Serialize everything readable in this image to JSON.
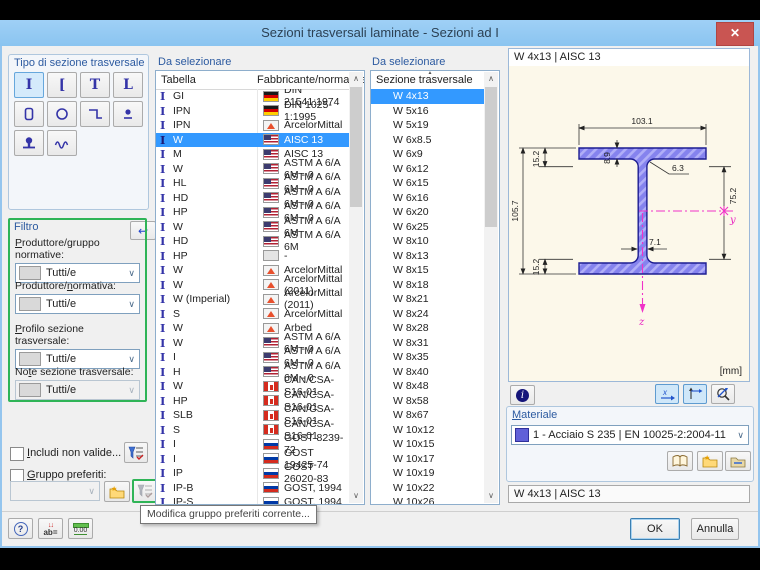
{
  "window": {
    "title": "Sezioni trasversali laminate - Sezioni ad I",
    "close_glyph": "✕"
  },
  "section_type_panel": {
    "title": "Tipo di sezione trasversale",
    "selected_index": 0,
    "types": [
      "i-section",
      "channel-section",
      "tee-section",
      "angle-section",
      "hollow-box-section",
      "pipe-section",
      "z-section",
      "round-bar-section",
      "rail-section",
      "corrugated-section"
    ],
    "glyphs": {
      "i": "I",
      "channel": "[",
      "tee": "T",
      "angle": "L"
    },
    "reset_glyph": "↩"
  },
  "filter": {
    "title": "Filtro",
    "items": [
      {
        "label_pre": "",
        "label_accel": "P",
        "label_post": "roduttore/gruppo normative:",
        "value": "Tutti/e",
        "disabled": false
      },
      {
        "label_pre": "Produttore/",
        "label_accel": "n",
        "label_post": "ormativa:",
        "value": "Tutti/e",
        "disabled": false
      },
      {
        "label_pre": "",
        "label_accel": "P",
        "label_post": "rofilo sezione trasversale:",
        "value": "Tutti/e",
        "disabled": false
      },
      {
        "label_pre": "No",
        "label_accel": "t",
        "label_post": "e sezione trasversale:",
        "value": "Tutti/e",
        "disabled": true
      }
    ]
  },
  "checkboxes": {
    "include_invalid": {
      "label_pre": "",
      "label_accel": "I",
      "label_post": "ncludi non valide...",
      "checked": false
    },
    "favorites_group": {
      "label_pre": "",
      "label_accel": "G",
      "label_post": "ruppo preferiti:",
      "checked": false
    }
  },
  "tooltip": "Modifica gruppo preferiti corrente...",
  "table_panel": {
    "title": "Da selezionare",
    "columns": [
      "Tabella",
      "Fabbricante/normativa"
    ],
    "selected_index": 3,
    "rows": [
      {
        "name": "GI",
        "flag": "de",
        "norm": "DIN 21541:1974"
      },
      {
        "name": "IPN",
        "flag": "de",
        "norm": "DIN 1025-1:1995"
      },
      {
        "name": "IPN",
        "flag": "am",
        "norm": "ArcelorMittal"
      },
      {
        "name": "W",
        "flag": "us",
        "norm": "AISC 13"
      },
      {
        "name": "M",
        "flag": "us",
        "norm": "AISC 13"
      },
      {
        "name": "W",
        "flag": "us",
        "norm": "ASTM A 6/A 6M - 0"
      },
      {
        "name": "HL",
        "flag": "us",
        "norm": "ASTM A 6/A 6M - 0"
      },
      {
        "name": "HD",
        "flag": "us",
        "norm": "ASTM A 6/A 6M - 0"
      },
      {
        "name": "HP",
        "flag": "us",
        "norm": "ASTM A 6/A 6M - 0"
      },
      {
        "name": "W",
        "flag": "us",
        "norm": "ASTM A 6/A 6M"
      },
      {
        "name": "HD",
        "flag": "us",
        "norm": "ASTM A 6/A 6M"
      },
      {
        "name": "HP",
        "flag": "none",
        "norm": "-"
      },
      {
        "name": "W",
        "flag": "am",
        "norm": "ArcelorMittal"
      },
      {
        "name": "W",
        "flag": "am",
        "norm": "ArcelorMittal (2011)"
      },
      {
        "name": "W (Imperial)",
        "flag": "am",
        "norm": "ArcelorMittal (2011)"
      },
      {
        "name": "S",
        "flag": "am",
        "norm": "ArcelorMittal"
      },
      {
        "name": "W",
        "flag": "am",
        "norm": "Arbed"
      },
      {
        "name": "W",
        "flag": "us",
        "norm": "ASTM A 6/A 6M - 0"
      },
      {
        "name": "I",
        "flag": "us",
        "norm": "ASTM A 6/A 6M - 0"
      },
      {
        "name": "H",
        "flag": "us",
        "norm": "ASTM A 6/A 6M - 0"
      },
      {
        "name": "W",
        "flag": "ca",
        "norm": "CAN/CSA-S16-01"
      },
      {
        "name": "HP",
        "flag": "ca",
        "norm": "CAN/CSA-S16-01"
      },
      {
        "name": "SLB",
        "flag": "ca",
        "norm": "CAN/CSA-S16-01"
      },
      {
        "name": "S",
        "flag": "ca",
        "norm": "CAN/CSA-S16-01"
      },
      {
        "name": "I",
        "flag": "ru",
        "norm": "GOST 8239-72"
      },
      {
        "name": "I",
        "flag": "ru",
        "norm": "GOST 19425-74"
      },
      {
        "name": "IP",
        "flag": "ru",
        "norm": "GOST 26020-83"
      },
      {
        "name": "IP-B",
        "flag": "ru",
        "norm": "GOST, 1994"
      },
      {
        "name": "IP-S",
        "flag": "ru",
        "norm": "GOST, 1994"
      }
    ]
  },
  "size_panel": {
    "title": "Da selezionare",
    "header": "Sezione trasversale",
    "selected_index": 0,
    "items": [
      "W 4x13",
      "W 5x16",
      "W 5x19",
      "W 6x8.5",
      "W 6x9",
      "W 6x12",
      "W 6x15",
      "W 6x16",
      "W 6x20",
      "W 6x25",
      "W 8x10",
      "W 8x13",
      "W 8x15",
      "W 8x18",
      "W 8x21",
      "W 8x24",
      "W 8x28",
      "W 8x31",
      "W 8x35",
      "W 8x40",
      "W 8x48",
      "W 8x58",
      "W 8x67",
      "W 10x12",
      "W 10x15",
      "W 10x17",
      "W 10x19",
      "W 10x22",
      "W 10x26"
    ]
  },
  "preview": {
    "header": "W 4x13 | AISC 13",
    "units": "[mm]",
    "dims": {
      "width": "103.1",
      "flange_thickness": "8.9",
      "k_top": "15.2",
      "height": "105.7",
      "k_bottom": "15.2",
      "fillet": "6.3",
      "web_thickness": "7.1",
      "inner_height": "75.2"
    },
    "axes": {
      "y": "y",
      "z": "z"
    }
  },
  "material": {
    "title": "Materiale",
    "value": "1 - Acciaio S 235 | EN 10025-2:2004-11",
    "swatch_color": "#6060D8"
  },
  "section_field": "W 4x13 | AISC 13",
  "buttons": {
    "ok": "OK",
    "cancel": "Annulla"
  },
  "colors": {
    "titlebar": "#8FC7F2",
    "close": "#C95552",
    "selection": "#3399FF",
    "filter_frame": "#2FB457",
    "beam_fill": "#8583EE",
    "beam_outline": "#1D1D91",
    "preview_bg": "#FCF8EA",
    "axis_magenta": "#F032C8"
  }
}
